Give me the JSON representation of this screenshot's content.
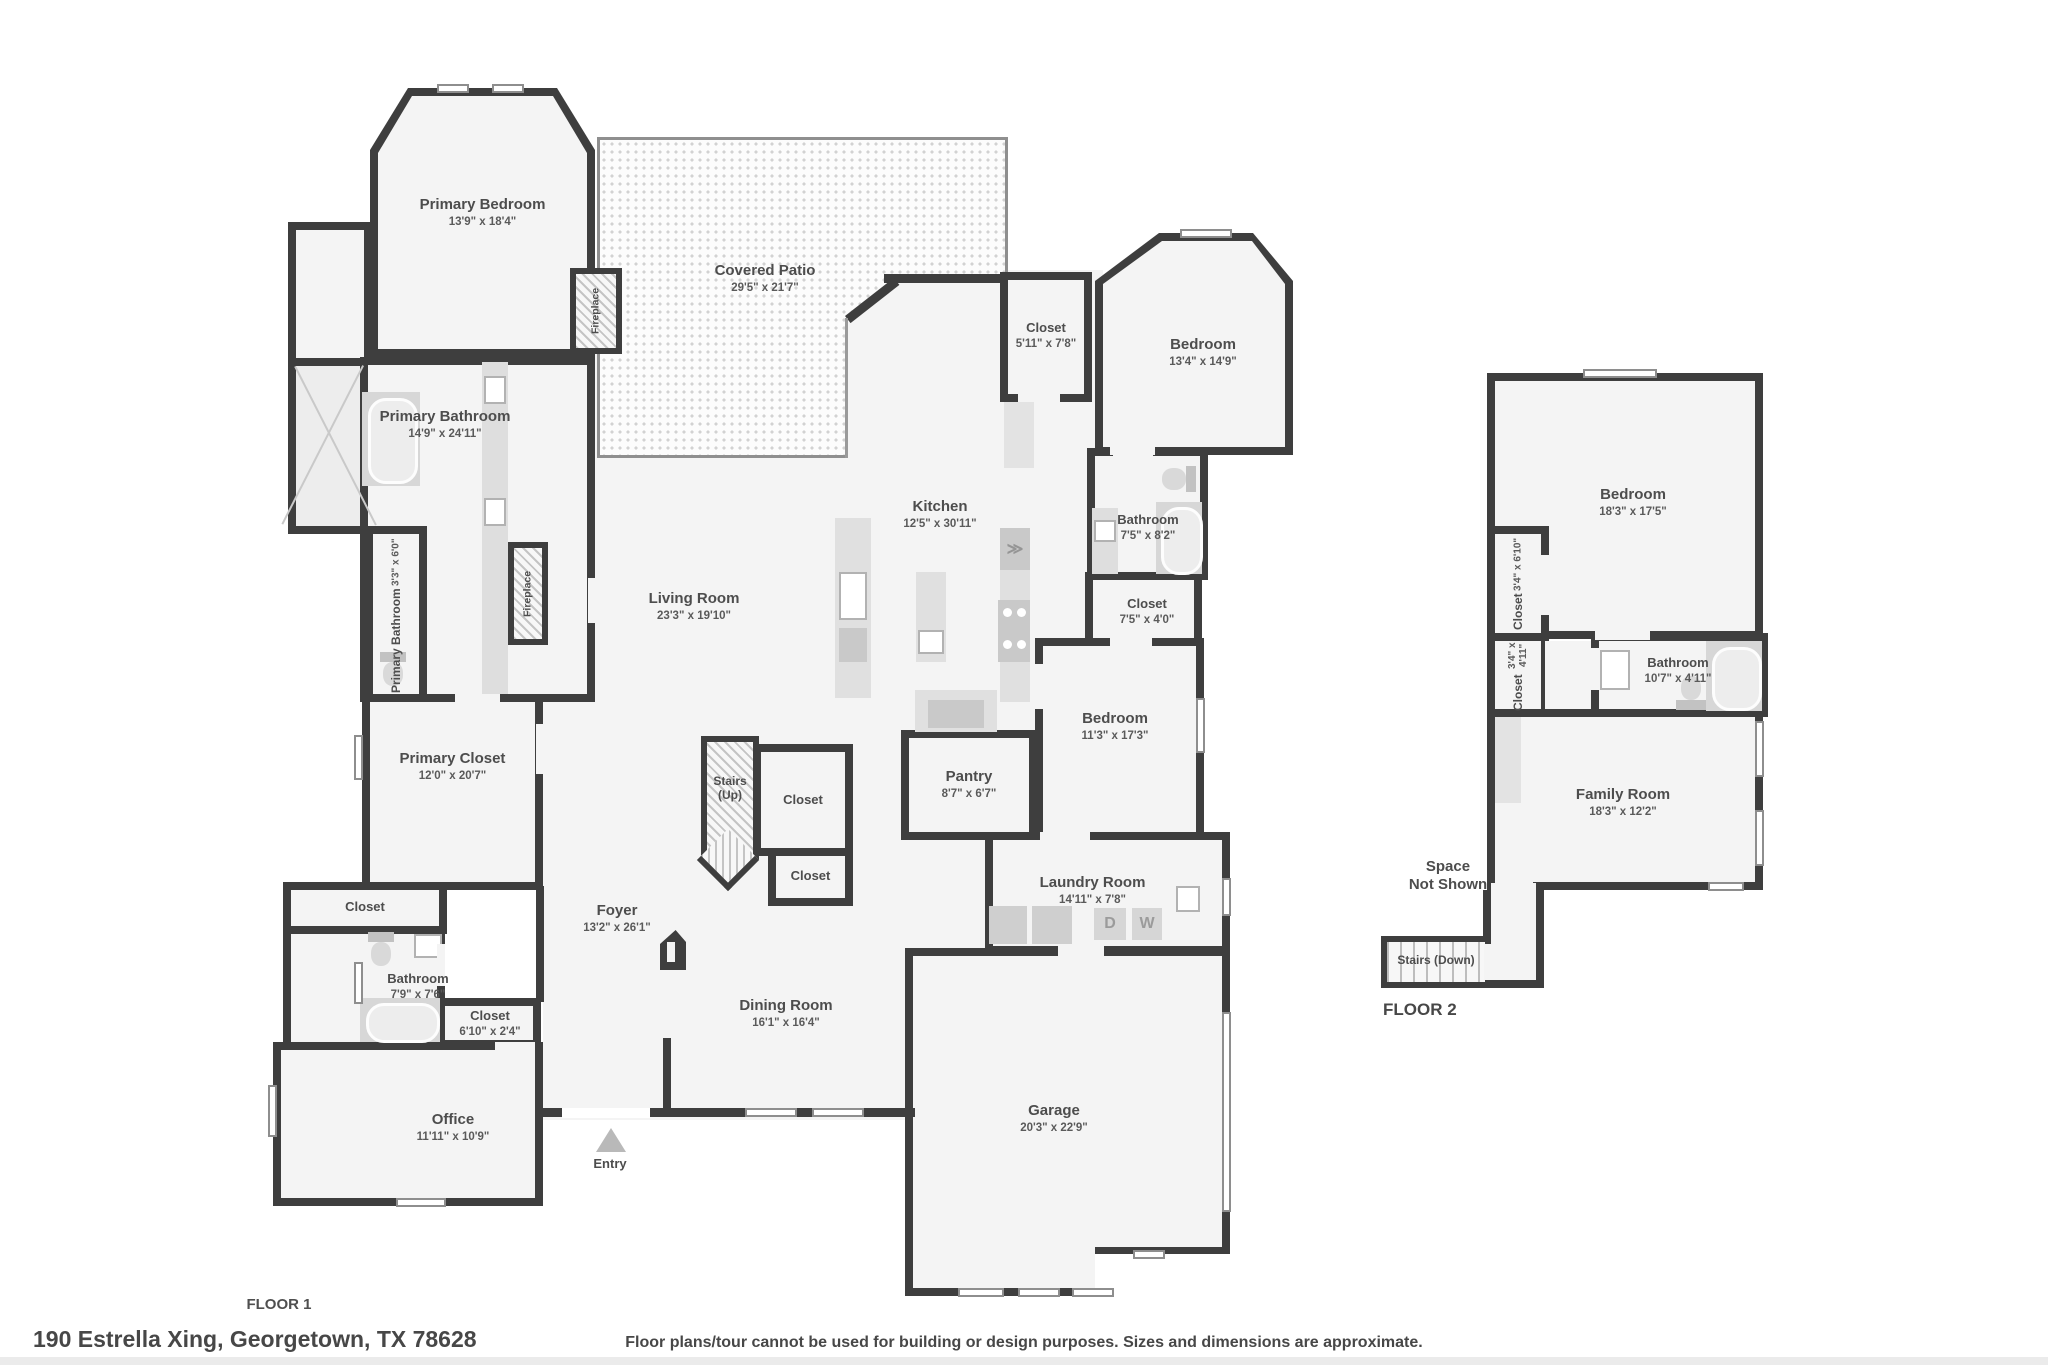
{
  "meta": {
    "address": "190 Estrella Xing, Georgetown, TX 78628",
    "disclaimer": "Floor plans/tour cannot be used for building or design purposes. Sizes and dimensions are approximate.",
    "floor1_label": "FLOOR 1",
    "floor2_label": "FLOOR 2"
  },
  "floor1": {
    "primary_bedroom": {
      "name": "Primary Bedroom",
      "dims": "13'9\" x 18'4\""
    },
    "covered_patio": {
      "name": "Covered Patio",
      "dims": "29'5\" x 21'7\""
    },
    "closet_hall": {
      "name": "Closet",
      "dims": "5'11\" x 7'8\""
    },
    "bedroom_ne": {
      "name": "Bedroom",
      "dims": "13'4\" x 14'9\""
    },
    "primary_bathroom": {
      "name": "Primary Bathroom",
      "dims": "14'9\" x 24'11\""
    },
    "primary_bathroom_wc": {
      "name": "Primary Bathroom",
      "dims": "3'3\" x 6'0\""
    },
    "fireplace_bedroom": {
      "name": "Fireplace"
    },
    "fireplace_living": {
      "name": "Fireplace"
    },
    "living_room": {
      "name": "Living Room",
      "dims": "23'3\" x 19'10\""
    },
    "kitchen": {
      "name": "Kitchen",
      "dims": "12'5\" x 30'11\""
    },
    "bathroom_e": {
      "name": "Bathroom",
      "dims": "7'5\" x 8'2\""
    },
    "closet_e": {
      "name": "Closet",
      "dims": "7'5\" x 4'0\""
    },
    "bedroom_e": {
      "name": "Bedroom",
      "dims": "11'3\" x 17'3\""
    },
    "primary_closet": {
      "name": "Primary Closet",
      "dims": "12'0\" x 20'7\""
    },
    "stairs_up": {
      "name": "Stairs\n(Up)"
    },
    "closet_stairs_a": {
      "name": "Closet"
    },
    "closet_stairs_b": {
      "name": "Closet"
    },
    "pantry": {
      "name": "Pantry",
      "dims": "8'7\" x 6'7\""
    },
    "laundry_room": {
      "name": "Laundry Room",
      "dims": "14'11\" x 7'8\"",
      "dryer": "D",
      "washer": "W"
    },
    "closet_w": {
      "name": "Closet"
    },
    "bathroom_w": {
      "name": "Bathroom",
      "dims": "7'9\" x 7'6\""
    },
    "closet_sw": {
      "name": "Closet",
      "dims": "6'10\" x 2'4\""
    },
    "foyer": {
      "name": "Foyer",
      "dims": "13'2\" x 26'1\""
    },
    "office": {
      "name": "Office",
      "dims": "11'11\" x 10'9\""
    },
    "dining_room": {
      "name": "Dining Room",
      "dims": "16'1\" x 16'4\""
    },
    "garage": {
      "name": "Garage",
      "dims": "20'3\" x 22'9\""
    },
    "entry": {
      "name": "Entry"
    }
  },
  "floor2": {
    "bedroom": {
      "name": "Bedroom",
      "dims": "18'3\" x 17'5\""
    },
    "closet_a": {
      "name": "Closet",
      "dims": "3'4\" x 6'10\""
    },
    "closet_b": {
      "name": "Closet",
      "dims": "3'4\" x 4'11\""
    },
    "bathroom": {
      "name": "Bathroom",
      "dims": "10'7\" x 4'11\""
    },
    "family_room": {
      "name": "Family Room",
      "dims": "18'3\" x 12'2\""
    },
    "space_not_shown": {
      "name": "Space\nNot Shown"
    },
    "stairs_down": {
      "name": "Stairs (Down)"
    }
  }
}
